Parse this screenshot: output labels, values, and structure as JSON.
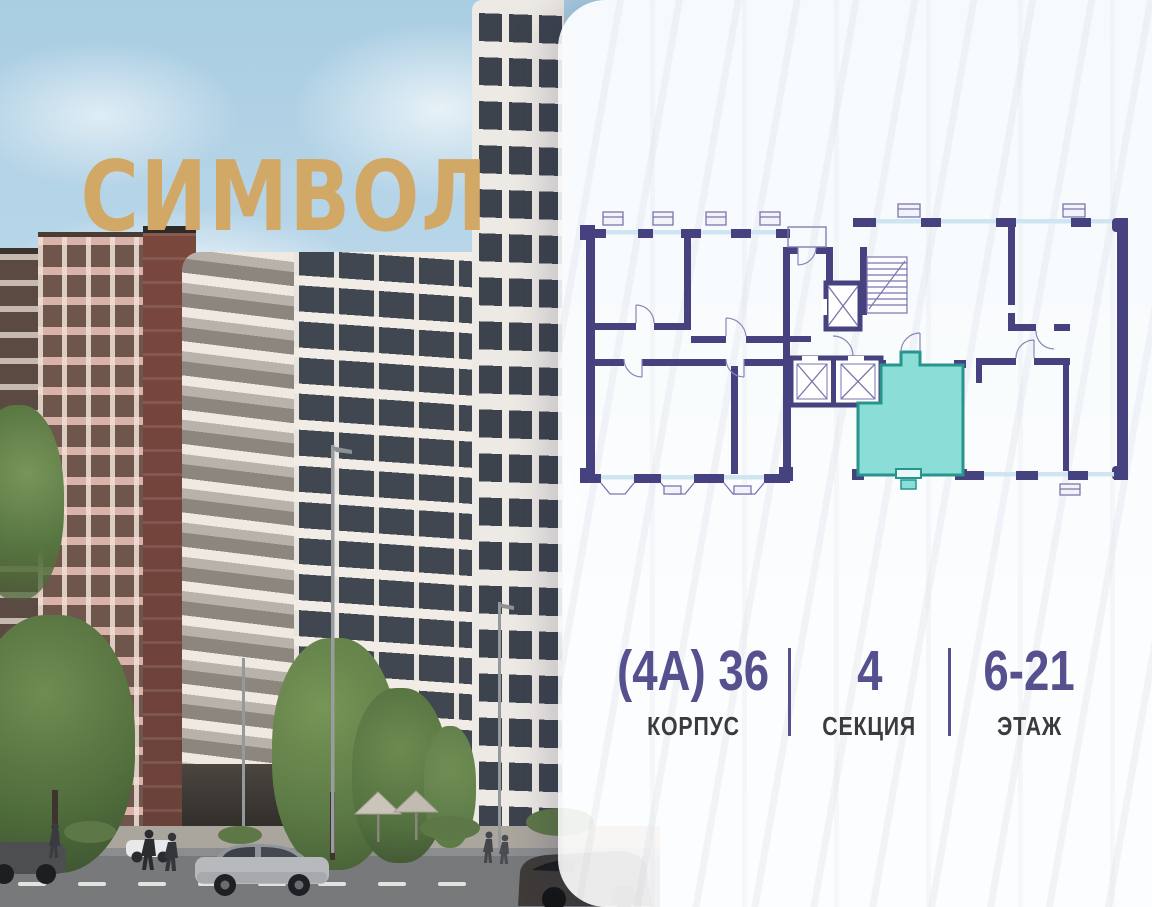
{
  "logo": {
    "text": "СИМВОЛ",
    "color": "#D2A866"
  },
  "panel": {
    "floorplan": {
      "description": "floor-plan-with-highlighted-studio-apartment",
      "highlighted_unit_fill": "#8ADED7",
      "highlighted_unit_stroke": "#27948E",
      "wall_color": "#46417F",
      "window_color": "#CFE6F2"
    },
    "stats": [
      {
        "id": "korpus",
        "value": "(4А) 36",
        "label": "КОРПУС"
      },
      {
        "id": "sektsiya",
        "value": "4",
        "label": "СЕКЦИЯ"
      },
      {
        "id": "etazh",
        "value": "6-21",
        "label": "ЭТАЖ"
      }
    ],
    "accent_color": "#55508E"
  }
}
